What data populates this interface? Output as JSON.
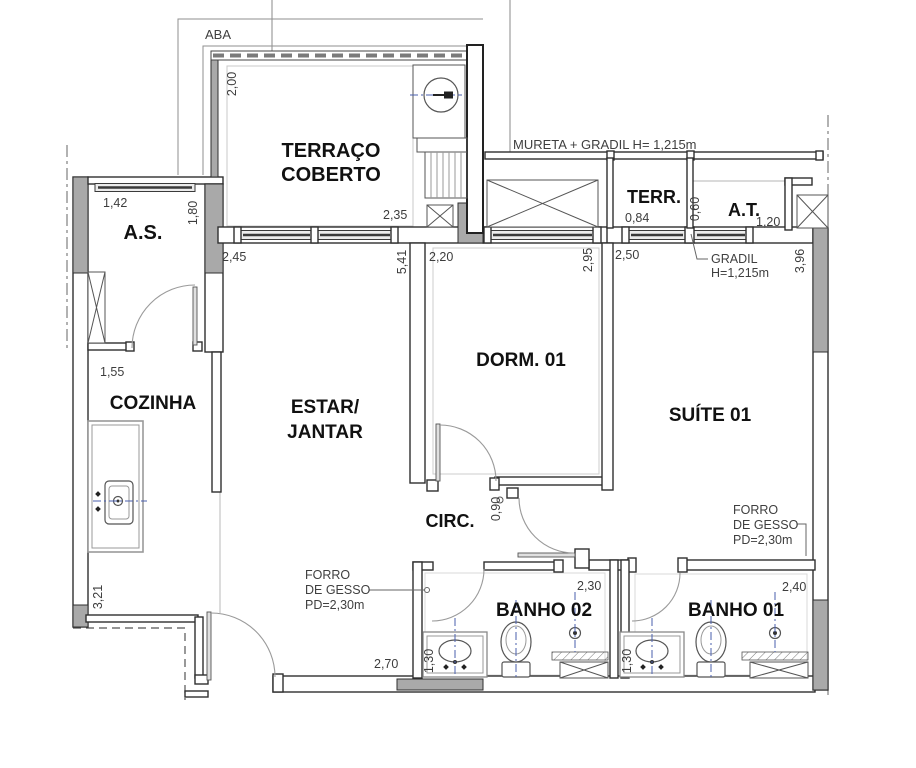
{
  "title": "Apartment floor plan",
  "plan": {
    "rooms": {
      "terraco": {
        "line1": "TERRAÇO",
        "line2": "COBERTO"
      },
      "as": "A.S.",
      "cozinha": "COZINHA",
      "estar": {
        "line1": "ESTAR/",
        "line2": "JANTAR"
      },
      "dorm": "DORM. 01",
      "suite": "SUÍTE 01",
      "circ": "CIRC.",
      "banho02": "BANHO 02",
      "banho01": "BANHO 01",
      "terr": "TERR.",
      "at": "A.T."
    },
    "dims": {
      "terraco_h": "2,00",
      "terraco_w": "2,35",
      "as_w": "1,42",
      "as_h": "1,80",
      "cozinha_w": "1,55",
      "cozinha_h": "3,21",
      "estar_w": "2,45",
      "estar_h": "5,41",
      "estar_bottom": "2,70",
      "dorm_w": "2,20",
      "dorm_h": "2,95",
      "suite_w": "2,50",
      "suite_h": "3,96",
      "terr_w": "0,84",
      "terr_at": "0,60",
      "at_w": "1,20",
      "circ_w": "0,90",
      "banho02_w": "2,30",
      "banho02_sink": "1,30",
      "banho01_w": "2,40",
      "banho01_sink": "1,30"
    },
    "annotations": {
      "aba": "ABA",
      "mureta": "MURETA + GRADIL  H= 1,215m",
      "gradil": {
        "line1": "GRADIL",
        "line2": "H=1,215m"
      },
      "forro": {
        "line1": "FORRO",
        "line2": "DE GESSO",
        "line3": "PD=2,30m"
      }
    }
  },
  "colors": {
    "wall_fill_gray": "#a9a9a9",
    "line_dark": "#2f2f2f",
    "centerline_blue": "#4a5fae",
    "annotation_gray": "#3f3f3f",
    "background": "#ffffff"
  }
}
